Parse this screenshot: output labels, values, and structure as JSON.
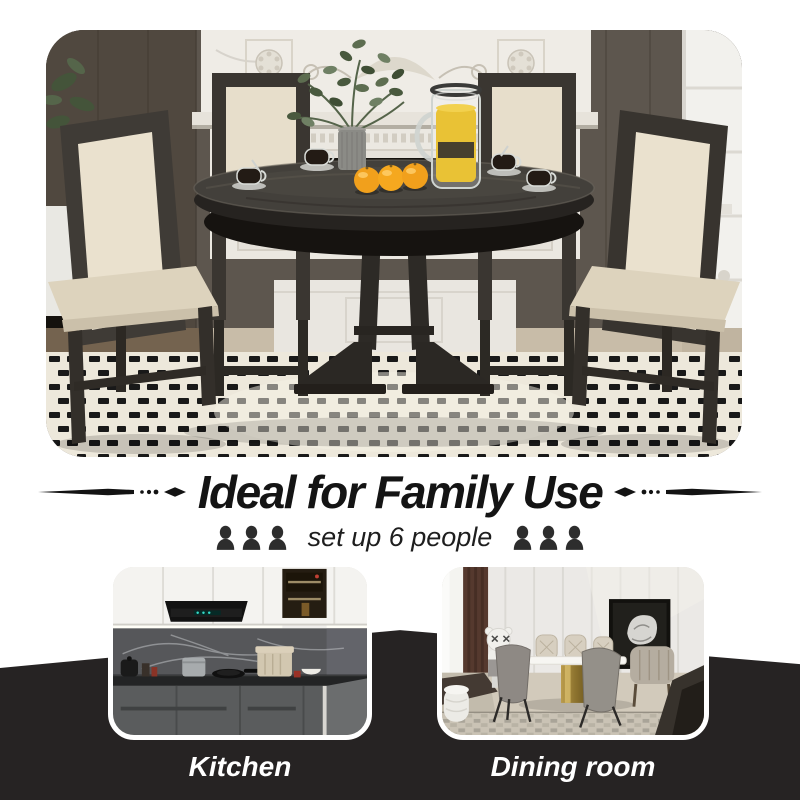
{
  "headline": {
    "title": "Ideal for Family Use"
  },
  "capacity": {
    "label": "set up 6 people",
    "people_count": 6,
    "icons_per_side": 3,
    "icon": "bust-silhouette"
  },
  "rooms": [
    {
      "label": "Kitchen"
    },
    {
      "label": "Dining room"
    }
  ],
  "colors": {
    "band_background": "#ffffff",
    "footer_background": "#262323",
    "headline_text": "#141414",
    "caption_text": "#ffffff",
    "icon_dark": "#2d2d2d",
    "juice_accent": "#e9c235",
    "orange_accent": "#f1a01c",
    "chair_upholstery": "#e7decb",
    "table_wood_dark": "#43403b"
  }
}
